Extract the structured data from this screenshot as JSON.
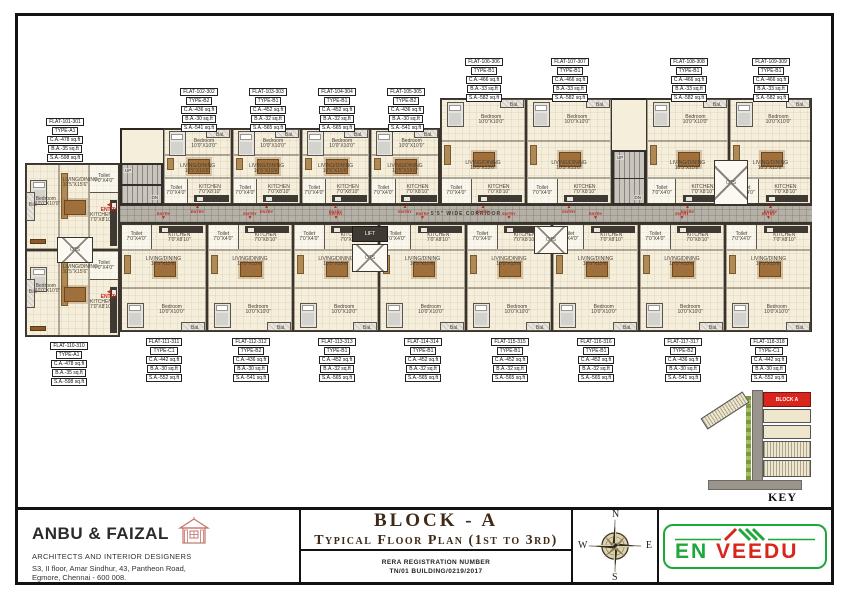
{
  "colors": {
    "accent_red": "#c0281e",
    "logo_green": "#1ea83a",
    "logo_red": "#d9261c",
    "floor_cream": "#f4eedb",
    "corridor_gray": "#b6b1a7",
    "wall": "#2b2622",
    "title_brown": "#3f2a18",
    "keyplan_block_red": "#d9261c"
  },
  "title_block": {
    "architect": {
      "name": "ANBU & FAIZAL",
      "subtitle": "ARCHITECTS AND INTERIOR DESIGNERS",
      "address1": "S3, II floor, Amar Sindhur, 43, Pantheon Road,",
      "address2": "Egmore,  Chennai - 600 008."
    },
    "drawing": {
      "block": "BLOCK - A",
      "title": "Typical Floor Plan (1st to 3rd)",
      "rera_label": "RERA REGISTRATION NUMBER",
      "rera_number": "TN/01 BUILDING/0219/2017"
    },
    "compass": {
      "n": "N",
      "s": "S",
      "e": "E",
      "w": "W"
    },
    "logo": {
      "word1": "EN",
      "word2": "VEEDU"
    }
  },
  "key_plan": {
    "label": "KEY PLAN",
    "block_label": "BLOCK A"
  },
  "plan": {
    "corridor_label": "5'5\" WIDE CORRIDOR",
    "entry_label": "ENTRY",
    "stair_up": "UP",
    "stair_dn": "DN",
    "lift_label": "LIFT",
    "ots_label": "OTS",
    "rooms": {
      "kitchen": "KITCHEN\n7'0\"X8'10\"",
      "living": "LIVING/DINING\n10'5\"X15'6\"",
      "bedroom": "Bedroom\n10'0\"X10'0\"",
      "toilet": "Toilet\n7'0\"X4'0\"",
      "balcony": "Bal."
    },
    "flats": [
      {
        "id": "101",
        "x": 25,
        "y": 163,
        "w": 95,
        "h": 87,
        "dir": "left",
        "lx": 36,
        "ly": 118,
        "lines": [
          "FLAT-101-301",
          "TYPE-A1",
          "C.A.-478 sq.ft",
          "B.A.-35 sq.ft",
          "S.A.-598 sq.ft"
        ]
      },
      {
        "id": "102",
        "x": 163,
        "y": 128,
        "w": 69,
        "h": 77,
        "dir": "up",
        "lx": 170,
        "ly": 88,
        "lines": [
          "FLAT-102-302",
          "TYPE-B2",
          "C.A.-436 sq.ft",
          "B.A.-30 sq.ft",
          "S.A.-541 sq.ft"
        ]
      },
      {
        "id": "103",
        "x": 232,
        "y": 128,
        "w": 69,
        "h": 77,
        "dir": "up",
        "lx": 239,
        "ly": 88,
        "lines": [
          "FLAT-103-303",
          "TYPE-B1",
          "C.A.-452 sq.ft",
          "B.A.-32 sq.ft",
          "S.A.-565 sq.ft"
        ]
      },
      {
        "id": "104",
        "x": 301,
        "y": 128,
        "w": 69,
        "h": 77,
        "dir": "up",
        "lx": 308,
        "ly": 88,
        "lines": [
          "FLAT-104-304",
          "TYPE-B1",
          "C.A.-452 sq.ft",
          "B.A.-32 sq.ft",
          "S.A.-565 sq.ft"
        ]
      },
      {
        "id": "105",
        "x": 370,
        "y": 128,
        "w": 70,
        "h": 77,
        "dir": "up",
        "lx": 377,
        "ly": 88,
        "lines": [
          "FLAT-105-305",
          "TYPE-B2",
          "C.A.-436 sq.ft",
          "B.A.-30 sq.ft",
          "S.A.-541 sq.ft"
        ]
      },
      {
        "id": "106",
        "x": 440,
        "y": 98,
        "w": 86,
        "h": 107,
        "dir": "up",
        "lx": 455,
        "ly": 58,
        "lines": [
          "FLAT-106-306",
          "TYPE-B1",
          "C.A.-466 sq.ft",
          "B.A.-33 sq.ft",
          "S.A.-582 sq.ft"
        ]
      },
      {
        "id": "107",
        "x": 526,
        "y": 98,
        "w": 86,
        "h": 107,
        "dir": "up",
        "lx": 541,
        "ly": 58,
        "lines": [
          "FLAT-107-307",
          "TYPE-B1",
          "C.A.-466 sq.ft",
          "B.A.-33 sq.ft",
          "S.A.-582 sq.ft"
        ]
      },
      {
        "id": "108",
        "x": 646,
        "y": 98,
        "w": 83,
        "h": 107,
        "dir": "up",
        "lx": 660,
        "ly": 58,
        "lines": [
          "FLAT-108-308",
          "TYPE-B1",
          "C.A.-466 sq.ft",
          "B.A.-33 sq.ft",
          "S.A.-582 sq.ft"
        ]
      },
      {
        "id": "109",
        "x": 729,
        "y": 98,
        "w": 83,
        "h": 107,
        "dir": "up",
        "lx": 742,
        "ly": 58,
        "lines": [
          "FLAT-109-309",
          "TYPE-B1",
          "C.A.-466 sq.ft",
          "B.A.-33 sq.ft",
          "S.A.-582 sq.ft"
        ]
      },
      {
        "id": "110",
        "x": 25,
        "y": 250,
        "w": 95,
        "h": 87,
        "dir": "left",
        "lx": 40,
        "ly": 342,
        "lines": [
          "FLAT-110-310",
          "TYPE-A1",
          "C.A.-478 sq.ft",
          "B.A.-35 sq.ft",
          "S.A.-598 sq.ft"
        ]
      },
      {
        "id": "111",
        "x": 120,
        "y": 223,
        "w": 87,
        "h": 109,
        "dir": "down",
        "lx": 135,
        "ly": 338,
        "lines": [
          "FLAT-111-311",
          "TYPE-C1",
          "C.A.-442 sq.ft",
          "B.A.-30 sq.ft",
          "S.A.-552 sq.ft"
        ]
      },
      {
        "id": "112",
        "x": 207,
        "y": 223,
        "w": 86,
        "h": 109,
        "dir": "down",
        "lx": 222,
        "ly": 338,
        "lines": [
          "FLAT-112-312",
          "TYPE-B2",
          "C.A.-436 sq.ft",
          "B.A.-30 sq.ft",
          "S.A.-541 sq.ft"
        ]
      },
      {
        "id": "113",
        "x": 293,
        "y": 223,
        "w": 86,
        "h": 109,
        "dir": "down",
        "lx": 308,
        "ly": 338,
        "lines": [
          "FLAT-113-313",
          "TYPE-B1",
          "C.A.-452 sq.ft",
          "B.A.-32 sq.ft",
          "S.A.-565 sq.ft"
        ]
      },
      {
        "id": "114",
        "x": 379,
        "y": 223,
        "w": 87,
        "h": 109,
        "dir": "down",
        "lx": 394,
        "ly": 338,
        "lines": [
          "FLAT-114-314",
          "TYPE-B1",
          "C.A.-452 sq.ft",
          "B.A.-32 sq.ft",
          "S.A.-565 sq.ft"
        ]
      },
      {
        "id": "115",
        "x": 466,
        "y": 223,
        "w": 86,
        "h": 109,
        "dir": "down",
        "lx": 481,
        "ly": 338,
        "lines": [
          "FLAT-115-315",
          "TYPE-B1",
          "C.A.-452 sq.ft",
          "B.A.-32 sq.ft",
          "S.A.-565 sq.ft"
        ]
      },
      {
        "id": "116",
        "x": 552,
        "y": 223,
        "w": 87,
        "h": 109,
        "dir": "down",
        "lx": 567,
        "ly": 338,
        "lines": [
          "FLAT-116-316",
          "TYPE-B1",
          "C.A.-452 sq.ft",
          "B.A.-32 sq.ft",
          "S.A.-565 sq.ft"
        ]
      },
      {
        "id": "117",
        "x": 639,
        "y": 223,
        "w": 86,
        "h": 109,
        "dir": "down",
        "lx": 654,
        "ly": 338,
        "lines": [
          "FLAT-117-317",
          "TYPE-B2",
          "C.A.-436 sq.ft",
          "B.A.-30 sq.ft",
          "S.A.-541 sq.ft"
        ]
      },
      {
        "id": "118",
        "x": 725,
        "y": 223,
        "w": 87,
        "h": 109,
        "dir": "down",
        "lx": 740,
        "ly": 338,
        "lines": [
          "FLAT-118-318",
          "TYPE-C1",
          "C.A.-442 sq.ft",
          "B.A.-30 sq.ft",
          "S.A.-552 sq.ft"
        ]
      }
    ]
  }
}
